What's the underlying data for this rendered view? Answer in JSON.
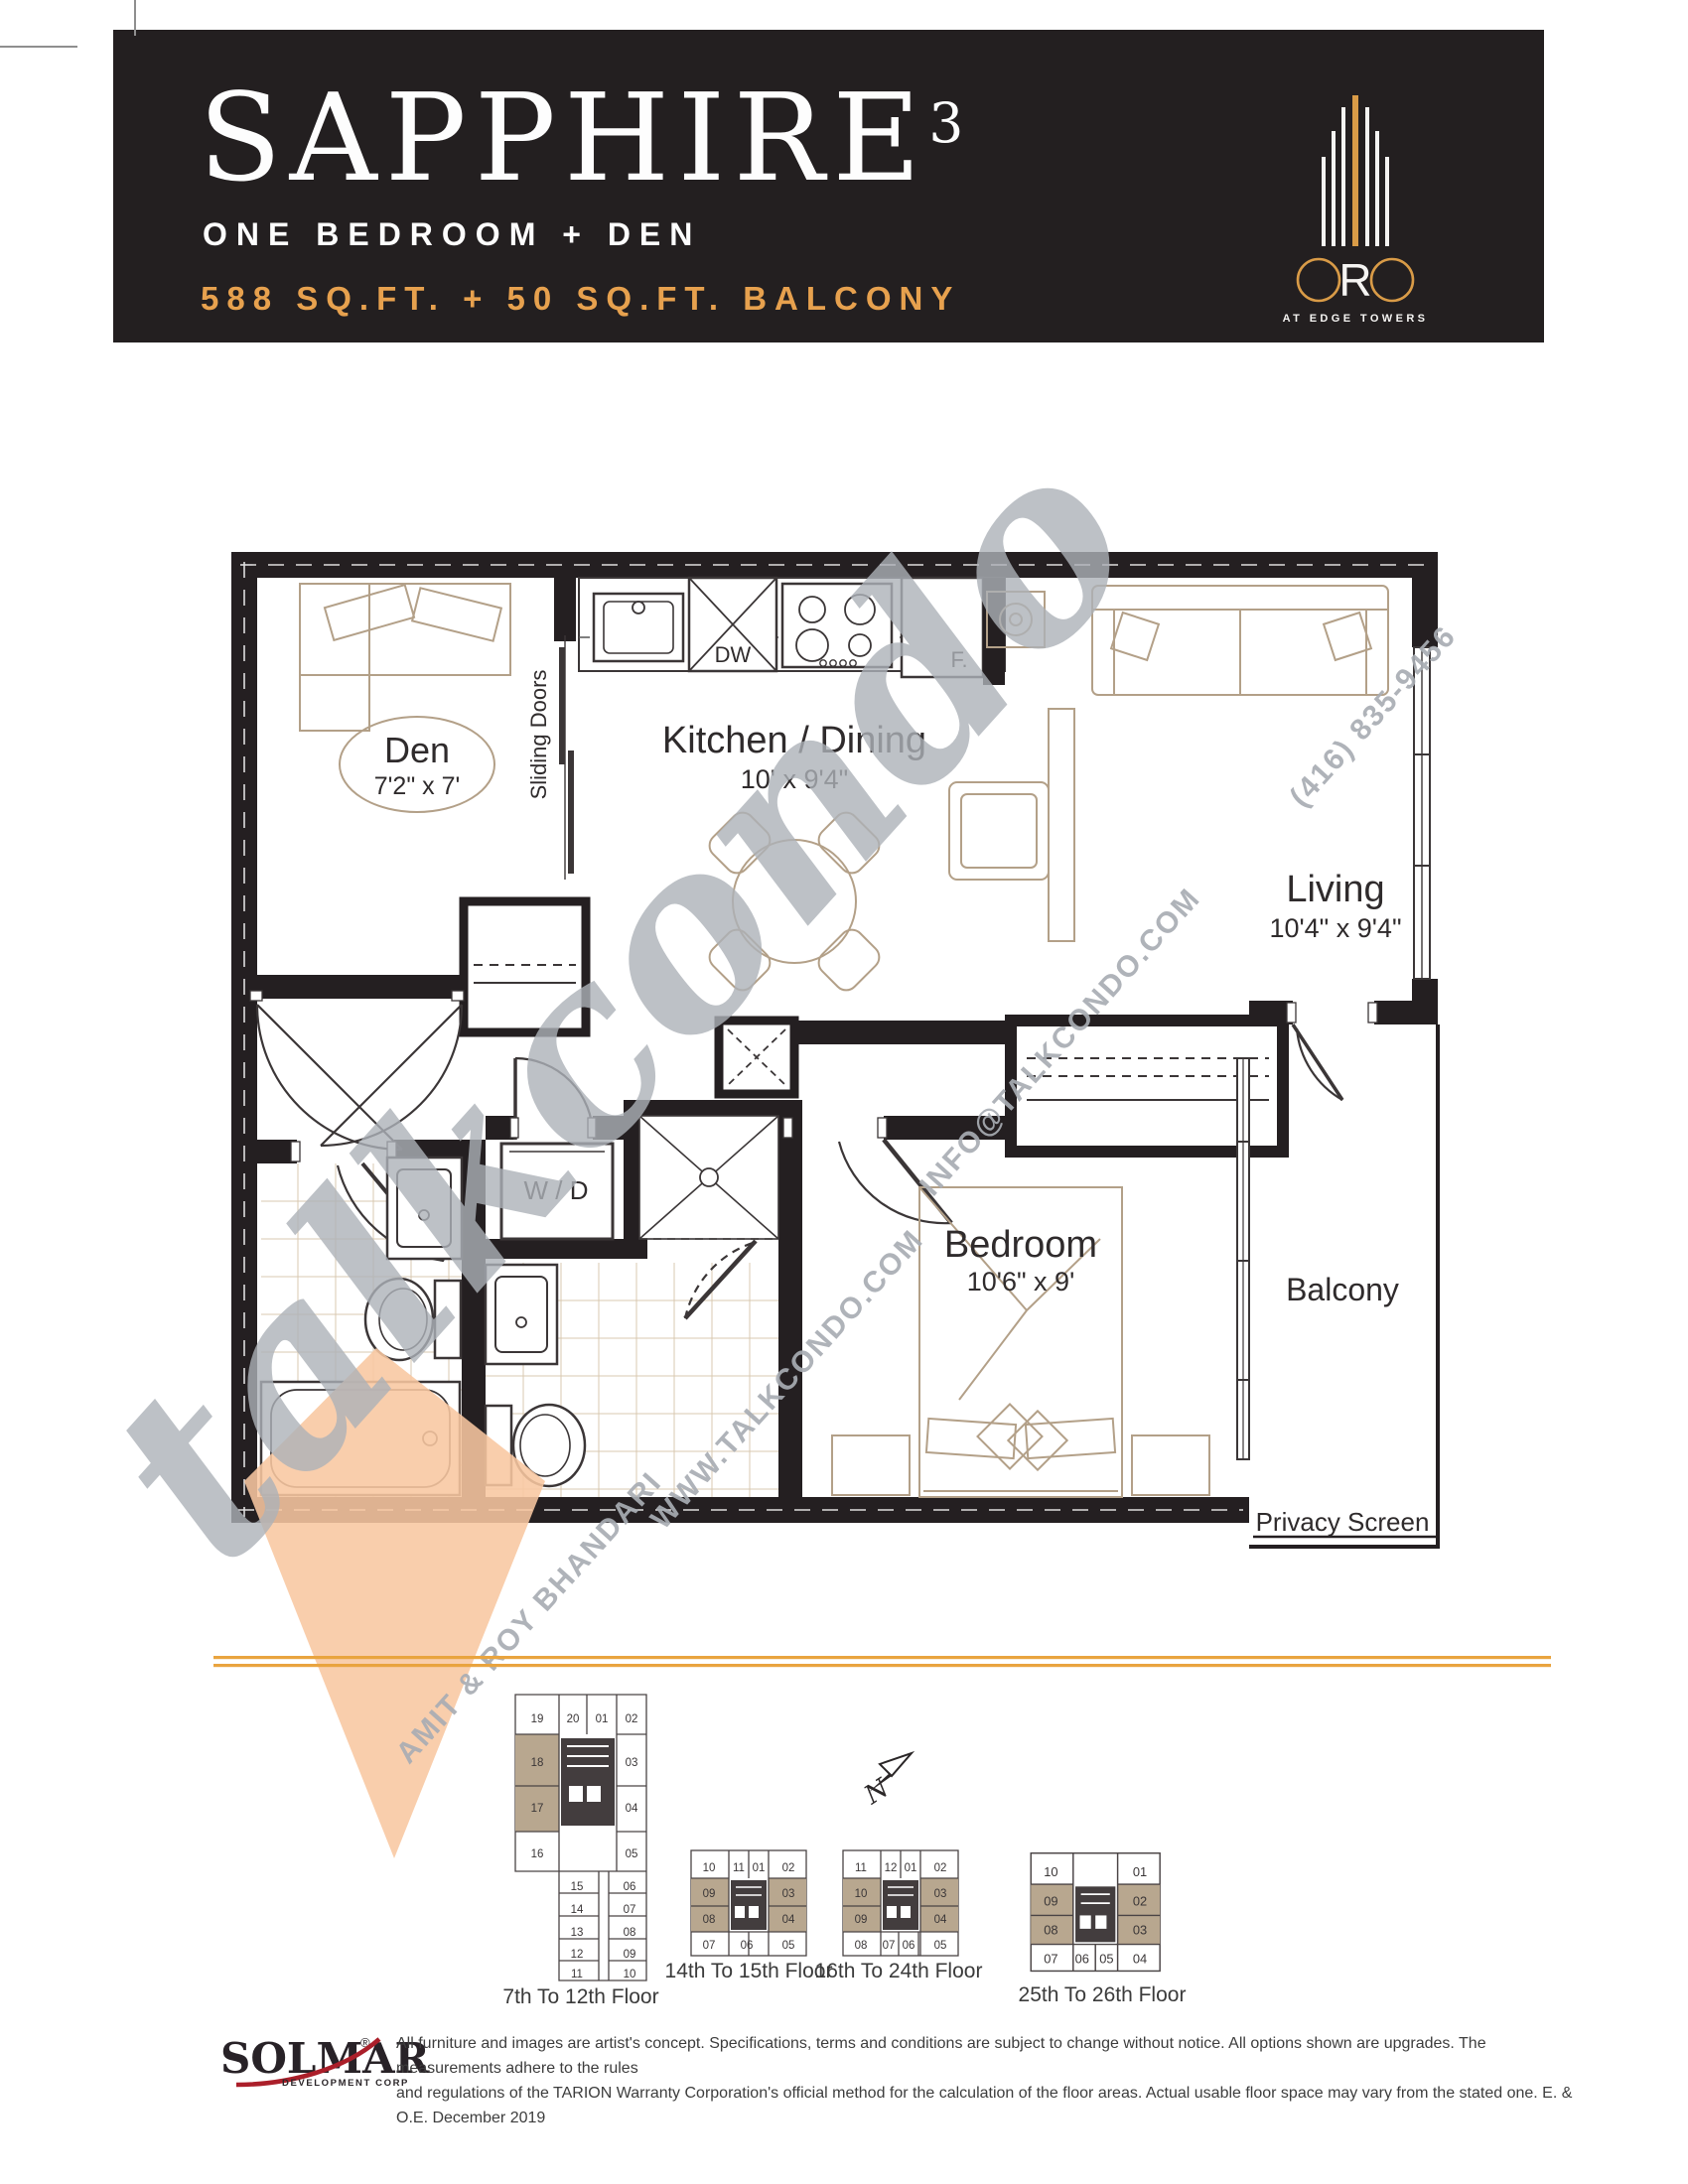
{
  "header": {
    "title": "SAPPHIRE",
    "title_sup": "3",
    "subtitle": "ONE BEDROOM + DEN",
    "area": "588 SQ.FT. + 50 SQ.FT. BALCONY"
  },
  "logo": {
    "word": "ORO",
    "r": "R",
    "tagline": "AT EDGE TOWERS"
  },
  "rooms": {
    "den": {
      "name": "Den",
      "dims": "7'2\" x 7'"
    },
    "kitchen": {
      "name": "Kitchen / Dining",
      "dims": "10' x 9'4\""
    },
    "living": {
      "name": "Living",
      "dims": "10'4\" x 9'4\""
    },
    "bedroom": {
      "name": "Bedroom",
      "dims": "10'6\" x 9'"
    },
    "balcony": {
      "name": "Balcony"
    },
    "labels": {
      "sliding_doors": "Sliding Doors",
      "dw": "DW",
      "fridge": "F.",
      "wd": "W / D",
      "privacy_screen": "Privacy Screen"
    }
  },
  "watermark": {
    "script": "talkcondo",
    "phone": "(416) 835-9456",
    "email": "INFO@TALKCONDO.COM",
    "website": "WWW.TALKCONDO.COM",
    "agents": "AMIT & ROY BHANDARI"
  },
  "north_label": "N",
  "keyplans": [
    {
      "caption": "7th To 12th Floor",
      "highlight_units": [
        "17",
        "18"
      ],
      "units": [
        "19",
        "20",
        "01",
        "02",
        "18",
        "03",
        "17",
        "04",
        "16",
        "05",
        "15",
        "06",
        "14",
        "07",
        "13",
        "08",
        "12",
        "09",
        "11",
        "10"
      ]
    },
    {
      "caption": "14th To 15th Floor",
      "highlight_units": [
        "09",
        "03",
        "08",
        "04"
      ],
      "units": [
        "10",
        "11",
        "01",
        "02",
        "09",
        "03",
        "08",
        "04",
        "07",
        "06",
        "05"
      ]
    },
    {
      "caption": "16th To 24th Floor",
      "highlight_units": [
        "10",
        "03",
        "09",
        "04"
      ],
      "units": [
        "11",
        "12",
        "01",
        "02",
        "10",
        "03",
        "09",
        "04",
        "08",
        "07",
        "06",
        "05"
      ]
    },
    {
      "caption": "25th To 26th Floor",
      "highlight_units": [
        "09",
        "02",
        "08",
        "03"
      ],
      "units": [
        "10",
        "01",
        "09",
        "02",
        "08",
        "03",
        "07",
        "06",
        "05",
        "04"
      ]
    }
  ],
  "footer": {
    "brand": "SOLMAR",
    "brand_reg": "®",
    "brand_sub": "DEVELOPMENT CORP",
    "disclaimer_line1": "All furniture and images are artist's concept. Specifications, terms and conditions are subject to change without notice. All options shown are upgrades. The measurements adhere to the rules",
    "disclaimer_line2": "and regulations of the TARION Warranty Corporation's official method for the calculation of the floor areas. Actual usable floor space may vary from the stated one. E. & O.E. December 2019"
  },
  "colors": {
    "header_bg": "#231f20",
    "gold": "#e7a14e",
    "rule_orange": "#e9a43f",
    "wall": "#241f21",
    "furniture_tan": "#b3a088",
    "tile": "#d9c9b1",
    "watermark_gray": "#b7bac0",
    "watermark_peach": "#f8c7a1",
    "keyplan_highlight": "#b8a78f",
    "swoosh_red": "#ab1f2a"
  }
}
